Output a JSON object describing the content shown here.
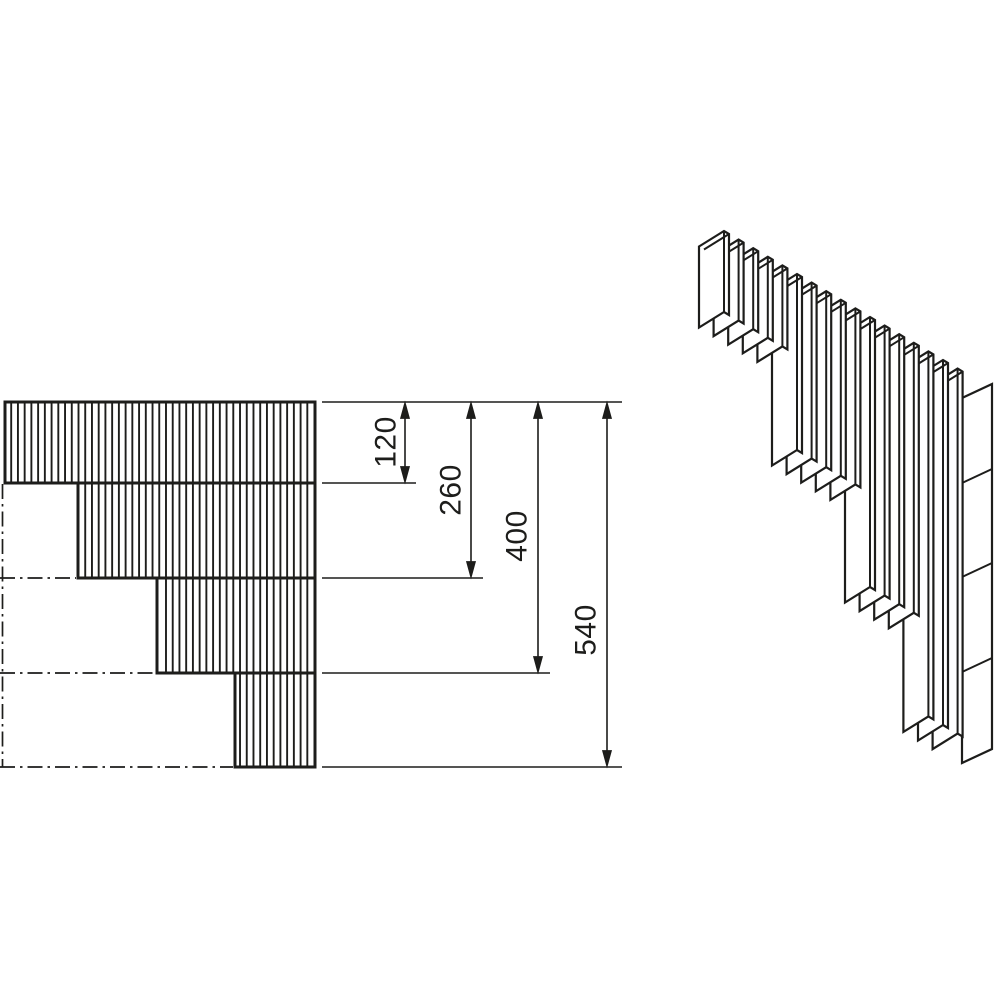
{
  "drawing": {
    "background_color": "#ffffff",
    "line_color": "#1d1d1b",
    "views": [
      {
        "id": "front-elevation"
      },
      {
        "id": "isometric"
      }
    ],
    "dimensions": [
      {
        "label": "120",
        "value": 120
      },
      {
        "label": "260",
        "value": 260
      },
      {
        "label": "400",
        "value": 400
      },
      {
        "label": "540",
        "value": 540
      }
    ],
    "step_heights": [
      120,
      260,
      400,
      540
    ],
    "band_count": 4,
    "slat_groups": 4
  }
}
